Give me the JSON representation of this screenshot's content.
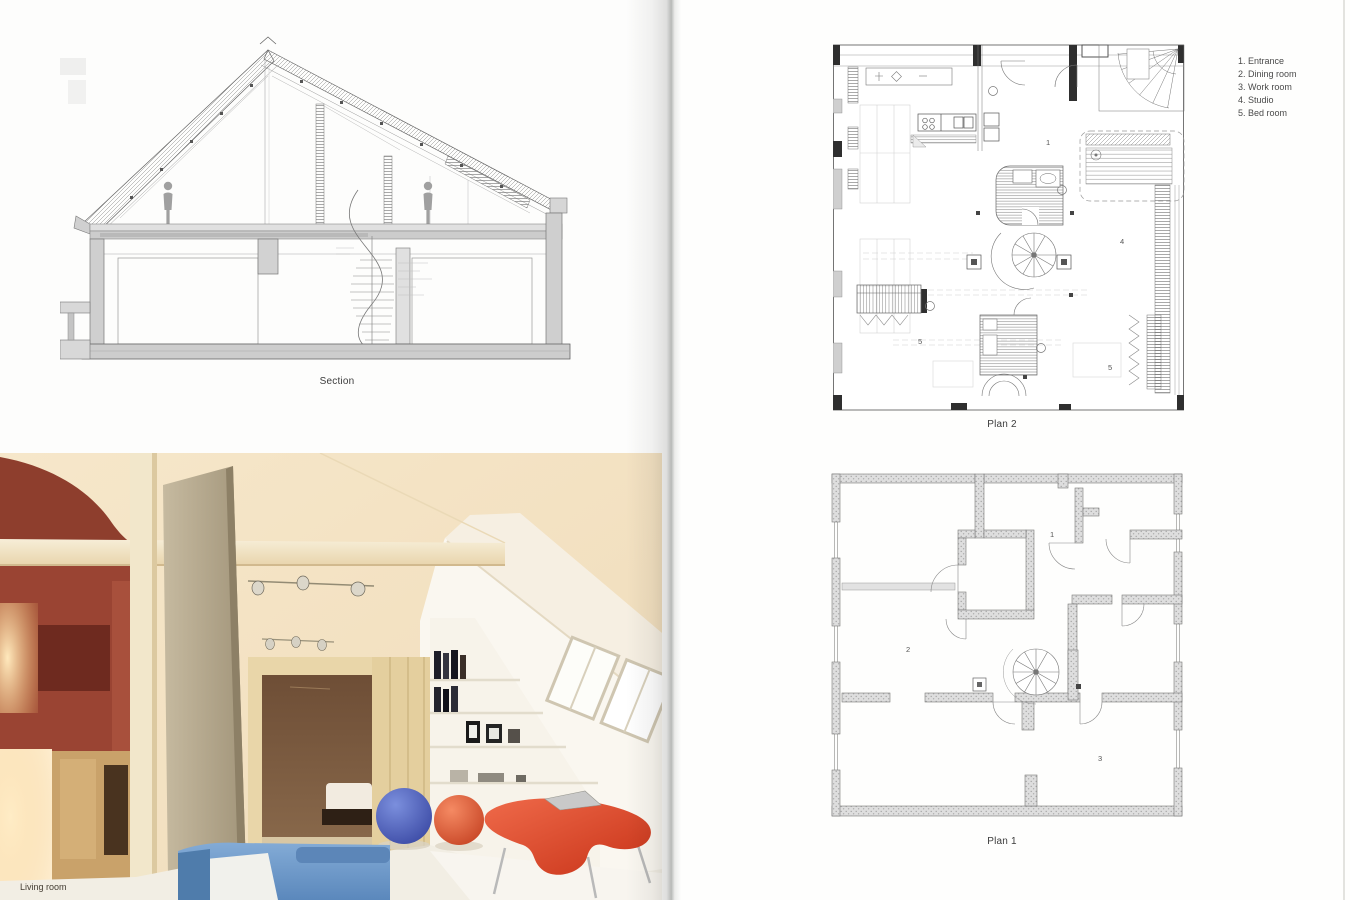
{
  "left_page": {
    "section": {
      "caption": "Section"
    },
    "photo": {
      "caption": "Living room"
    }
  },
  "right_page": {
    "plan_top": {
      "caption": "Plan 2",
      "rooms": [
        {
          "label": "1"
        },
        {
          "label": "4"
        },
        {
          "label": "5"
        },
        {
          "label": "5"
        }
      ]
    },
    "plan_bottom": {
      "caption": "Plan 1",
      "rooms": [
        {
          "label": "1"
        },
        {
          "label": "2"
        },
        {
          "label": "3"
        }
      ]
    },
    "legend": {
      "items": [
        {
          "text": "1. Entrance"
        },
        {
          "text": "2. Dining room"
        },
        {
          "text": "3. Work room"
        },
        {
          "text": "4. Studio"
        },
        {
          "text": "5. Bed room"
        }
      ]
    }
  },
  "colors": {
    "terracotta_wall": "#9a4433",
    "sofa_blue": "#7aa3cf",
    "pouf_blue": "#4456b8",
    "pouf_red": "#e05a38",
    "desk_red": "#d84226",
    "plan_line": "#555555",
    "wall_fill": "#d9d9d9"
  }
}
